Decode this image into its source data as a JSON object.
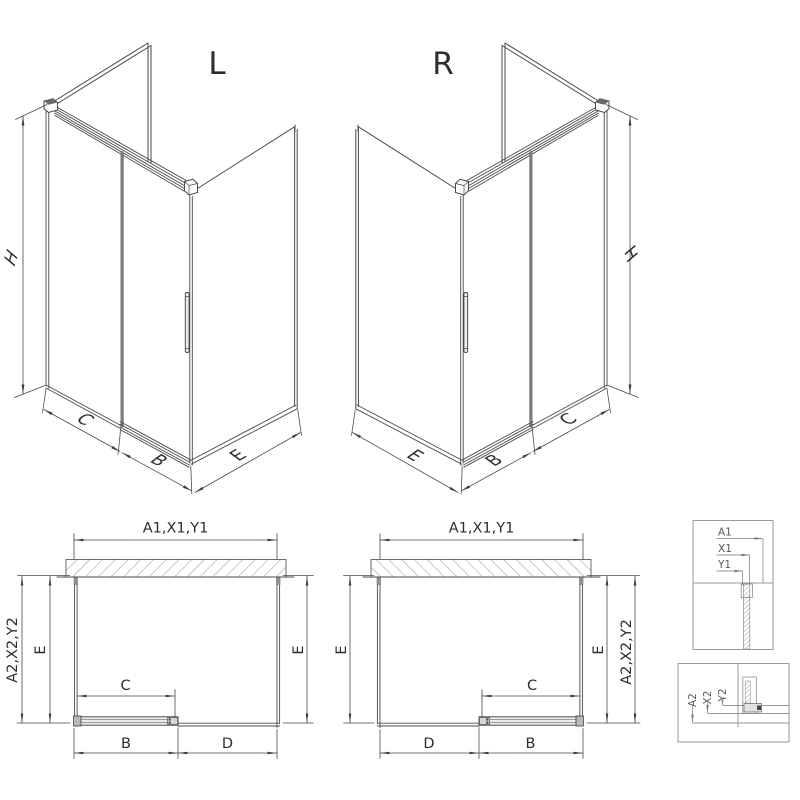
{
  "drawing": {
    "left_variant_label": "L",
    "right_variant_label": "R",
    "background": "#ffffff"
  },
  "dimensions": {
    "height": "H",
    "side_panel_depth": "E",
    "door_panel_width": "B",
    "opening_width": "C",
    "fixed_panel_width": "D",
    "overall_width_codes": "A1,X1,Y1",
    "overall_depth_codes": "A2,X2,Y2"
  },
  "detail_width_callout": {
    "rows": [
      "A1",
      "X1",
      "Y1"
    ]
  },
  "detail_depth_callout": {
    "rows": [
      "A2",
      "X2",
      "Y2"
    ]
  },
  "colors": {
    "line": "#4a4a4a",
    "dimension_line": "#3f3f3f",
    "detail_box_line": "#9a9a9a",
    "glass_edge_gray": "#7d7d7d",
    "hatch": "#787878",
    "text": "#2d2d2d",
    "detail_text": "#5a5a5a"
  }
}
